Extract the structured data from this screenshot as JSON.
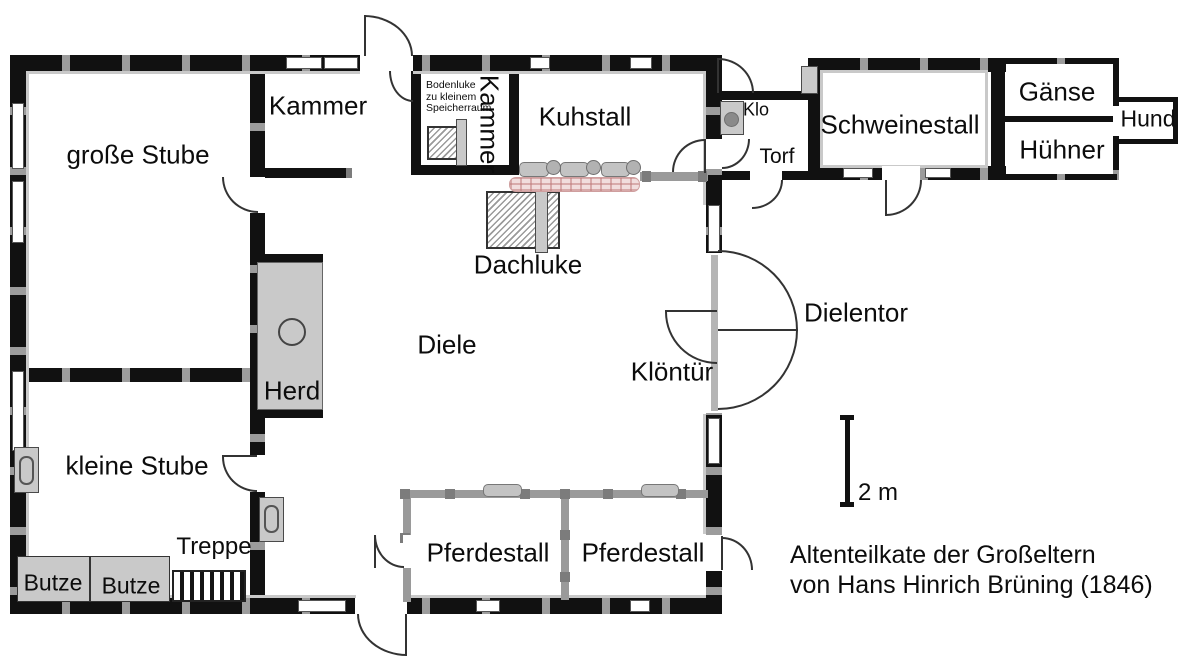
{
  "title": {
    "line1": "Altenteilkate der Großeltern",
    "line2": "von Hans Hinrich Brüning (1846)"
  },
  "scale_bar": {
    "label": "2 m"
  },
  "rooms": {
    "grosse_stube": "große Stube",
    "kammer_links": "Kammer",
    "kammer_klein": "Kammer",
    "kuhstall": "Kuhstall",
    "diele": "Diele",
    "kleine_stube": "kleine Stube",
    "pferdestall_links": "Pferdestall",
    "pferdestall_rechts": "Pferdestall",
    "schweinestall": "Schweinestall",
    "gaense": "Gänse",
    "huehner": "Hühner",
    "hund": "Hund",
    "klo": "Klo",
    "torf": "Torf"
  },
  "features": {
    "herd": "Herd",
    "dachluke": "Dachluke",
    "dielentor": "Dielentor",
    "kloentuer": "Klöntür",
    "treppe": "Treppe",
    "butze_1": "Butze",
    "butze_2": "Butze",
    "bodenluke_line1": "Bodenluke",
    "bodenluke_line2": "zu kleinem",
    "bodenluke_line3": "Speicherraum"
  },
  "colors": {
    "wall": "#111111",
    "partition_wall": "#9a9a9a",
    "lining": "#c9c9c9",
    "furniture_fill": "#c9c9c9",
    "trough_fill": "#f1dddd",
    "trough_line": "#cf9f9f",
    "background": "#ffffff",
    "text": "#0c0c0c"
  }
}
